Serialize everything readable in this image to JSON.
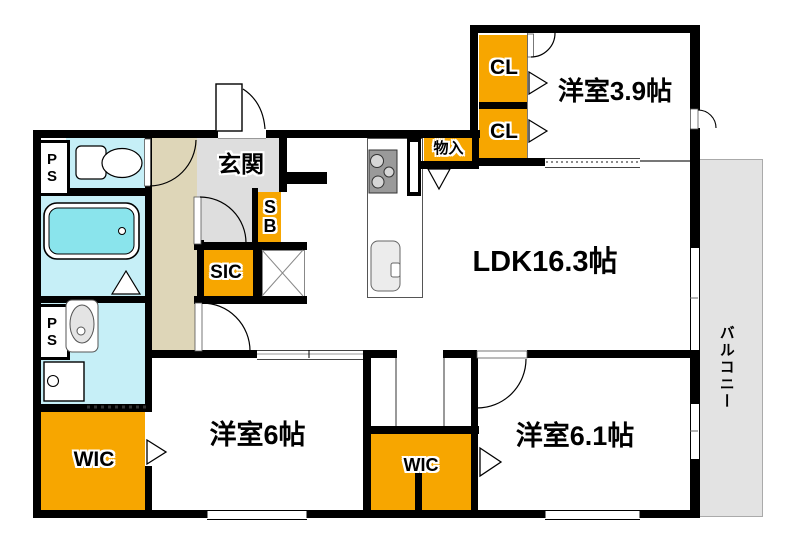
{
  "plan": {
    "title": "floor-plan",
    "rooms": {
      "ldk": {
        "label": "LDK16.3帖"
      },
      "bedroom_39": {
        "label": "洋室3.9帖"
      },
      "bedroom_6": {
        "label": "洋室6帖"
      },
      "bedroom_61": {
        "label": "洋室6.1帖"
      },
      "entrance": {
        "label": "玄関"
      },
      "balcony": {
        "label": "バルコニー"
      }
    },
    "storage": {
      "cl_upper": {
        "label": "CL"
      },
      "cl_lower": {
        "label": "CL"
      },
      "wic_left": {
        "label": "WIC"
      },
      "wic_center": {
        "label": "WIC"
      },
      "sic": {
        "label": "SIC"
      },
      "sb": {
        "label": "SB"
      },
      "monoire": {
        "label": "物入"
      }
    },
    "utility": {
      "ps_top": {
        "label": "PS"
      },
      "ps_bottom": {
        "label": "PS"
      }
    },
    "colors": {
      "closet_orange": "#f7a600",
      "water_cyan": "#c6eff7",
      "tub_fill": "#8ae4ec",
      "hall_beige": "#ded6b8",
      "entry_gray": "#dedede",
      "balcony_gray": "#e3e3e3",
      "wall_black": "#000000"
    }
  }
}
